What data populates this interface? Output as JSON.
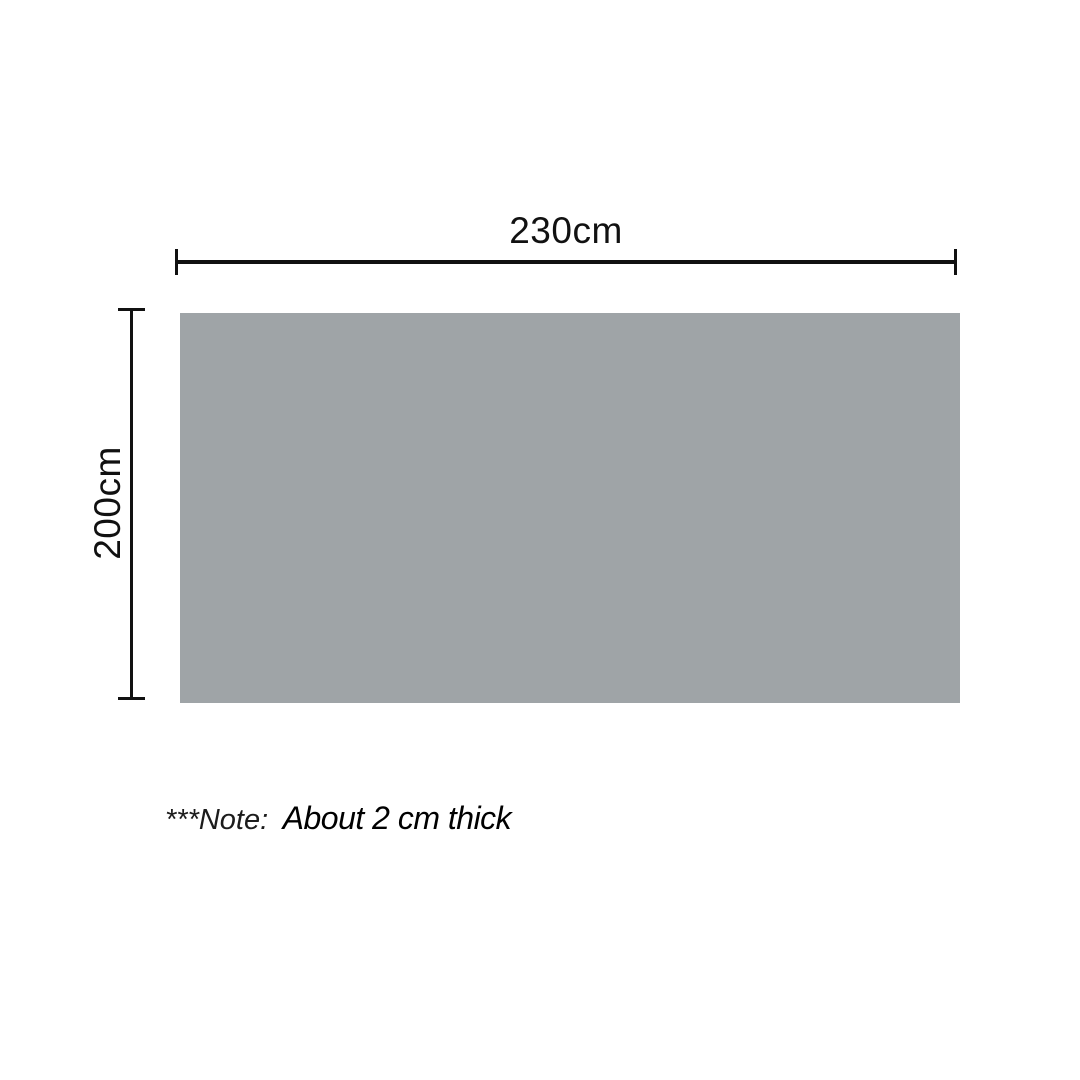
{
  "diagram": {
    "product": "flat-panel-top-view",
    "rect_color": "#9fa4a7",
    "line_color": "#111111",
    "width_dimension": {
      "label": "230cm",
      "value_cm": 230
    },
    "height_dimension": {
      "label": "200cm",
      "value_cm": 200
    },
    "note": {
      "prefix": "***Note:",
      "text": "About 2 cm thick",
      "thickness_cm": 2
    }
  }
}
